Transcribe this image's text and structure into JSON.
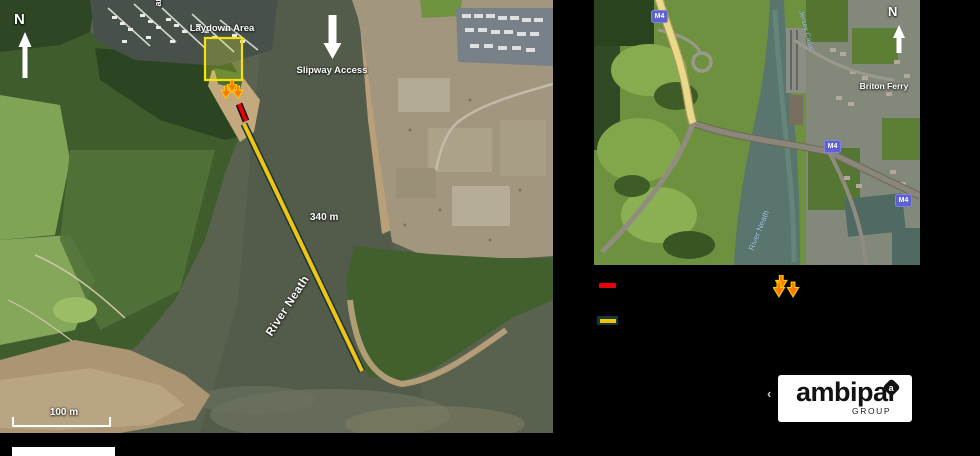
{
  "main_map": {
    "north_label": "N",
    "marina_label_vertical": "anna",
    "laydown_area_label": "Laydown Area",
    "slipway_access_label": "Slipway Access",
    "distance_label": "340 m",
    "river_label": "River Neath",
    "scale_bar_label": "100 m"
  },
  "inset_map": {
    "north_label": "N",
    "town_label": "Briton Ferry",
    "canal_label": "Jersey Canal",
    "river_label": "River Neath",
    "motorway_shield": "M4"
  },
  "legend": {
    "boom_swatch_color": "#e8000d",
    "route_swatch_color": "#f2c40e",
    "route_swatch_border_color": "#16393e",
    "marker_color": "#ff7a00"
  },
  "logo": {
    "crop_mark": "‹",
    "brand": "ambipar",
    "mark_letter": "a",
    "subtitle": "GROUP"
  }
}
